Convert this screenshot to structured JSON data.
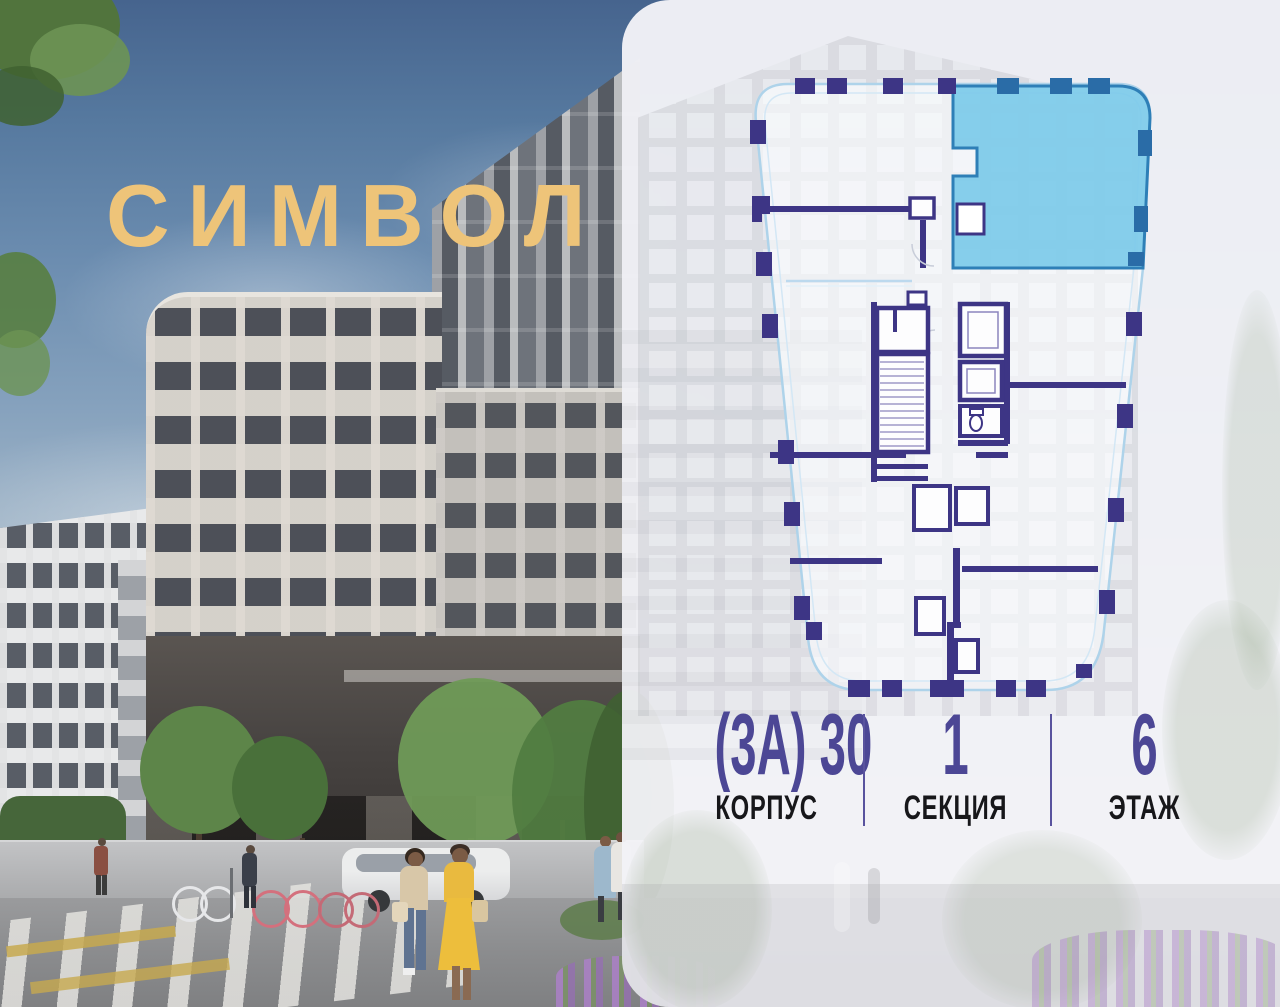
{
  "brand": {
    "logo_text": "СИМВОЛ",
    "logo_color": "#eec479"
  },
  "card": {
    "background": "#f2f3f7",
    "info": {
      "accent_color": "#4c4795",
      "label_color": "#17171a",
      "columns": [
        {
          "value": "(3А) 30",
          "label": "КОРПУС"
        },
        {
          "value": "1",
          "label": "СЕКЦИЯ"
        },
        {
          "value": "6",
          "label": "ЭТАЖ"
        }
      ]
    }
  },
  "floorplan": {
    "wall_color": "#3d3585",
    "outline_color": "#aed3ea",
    "highlight_fill": "#7ccae9",
    "highlight_border": "#2e7fb7",
    "highlight_block_color": "#2a6ca7"
  }
}
